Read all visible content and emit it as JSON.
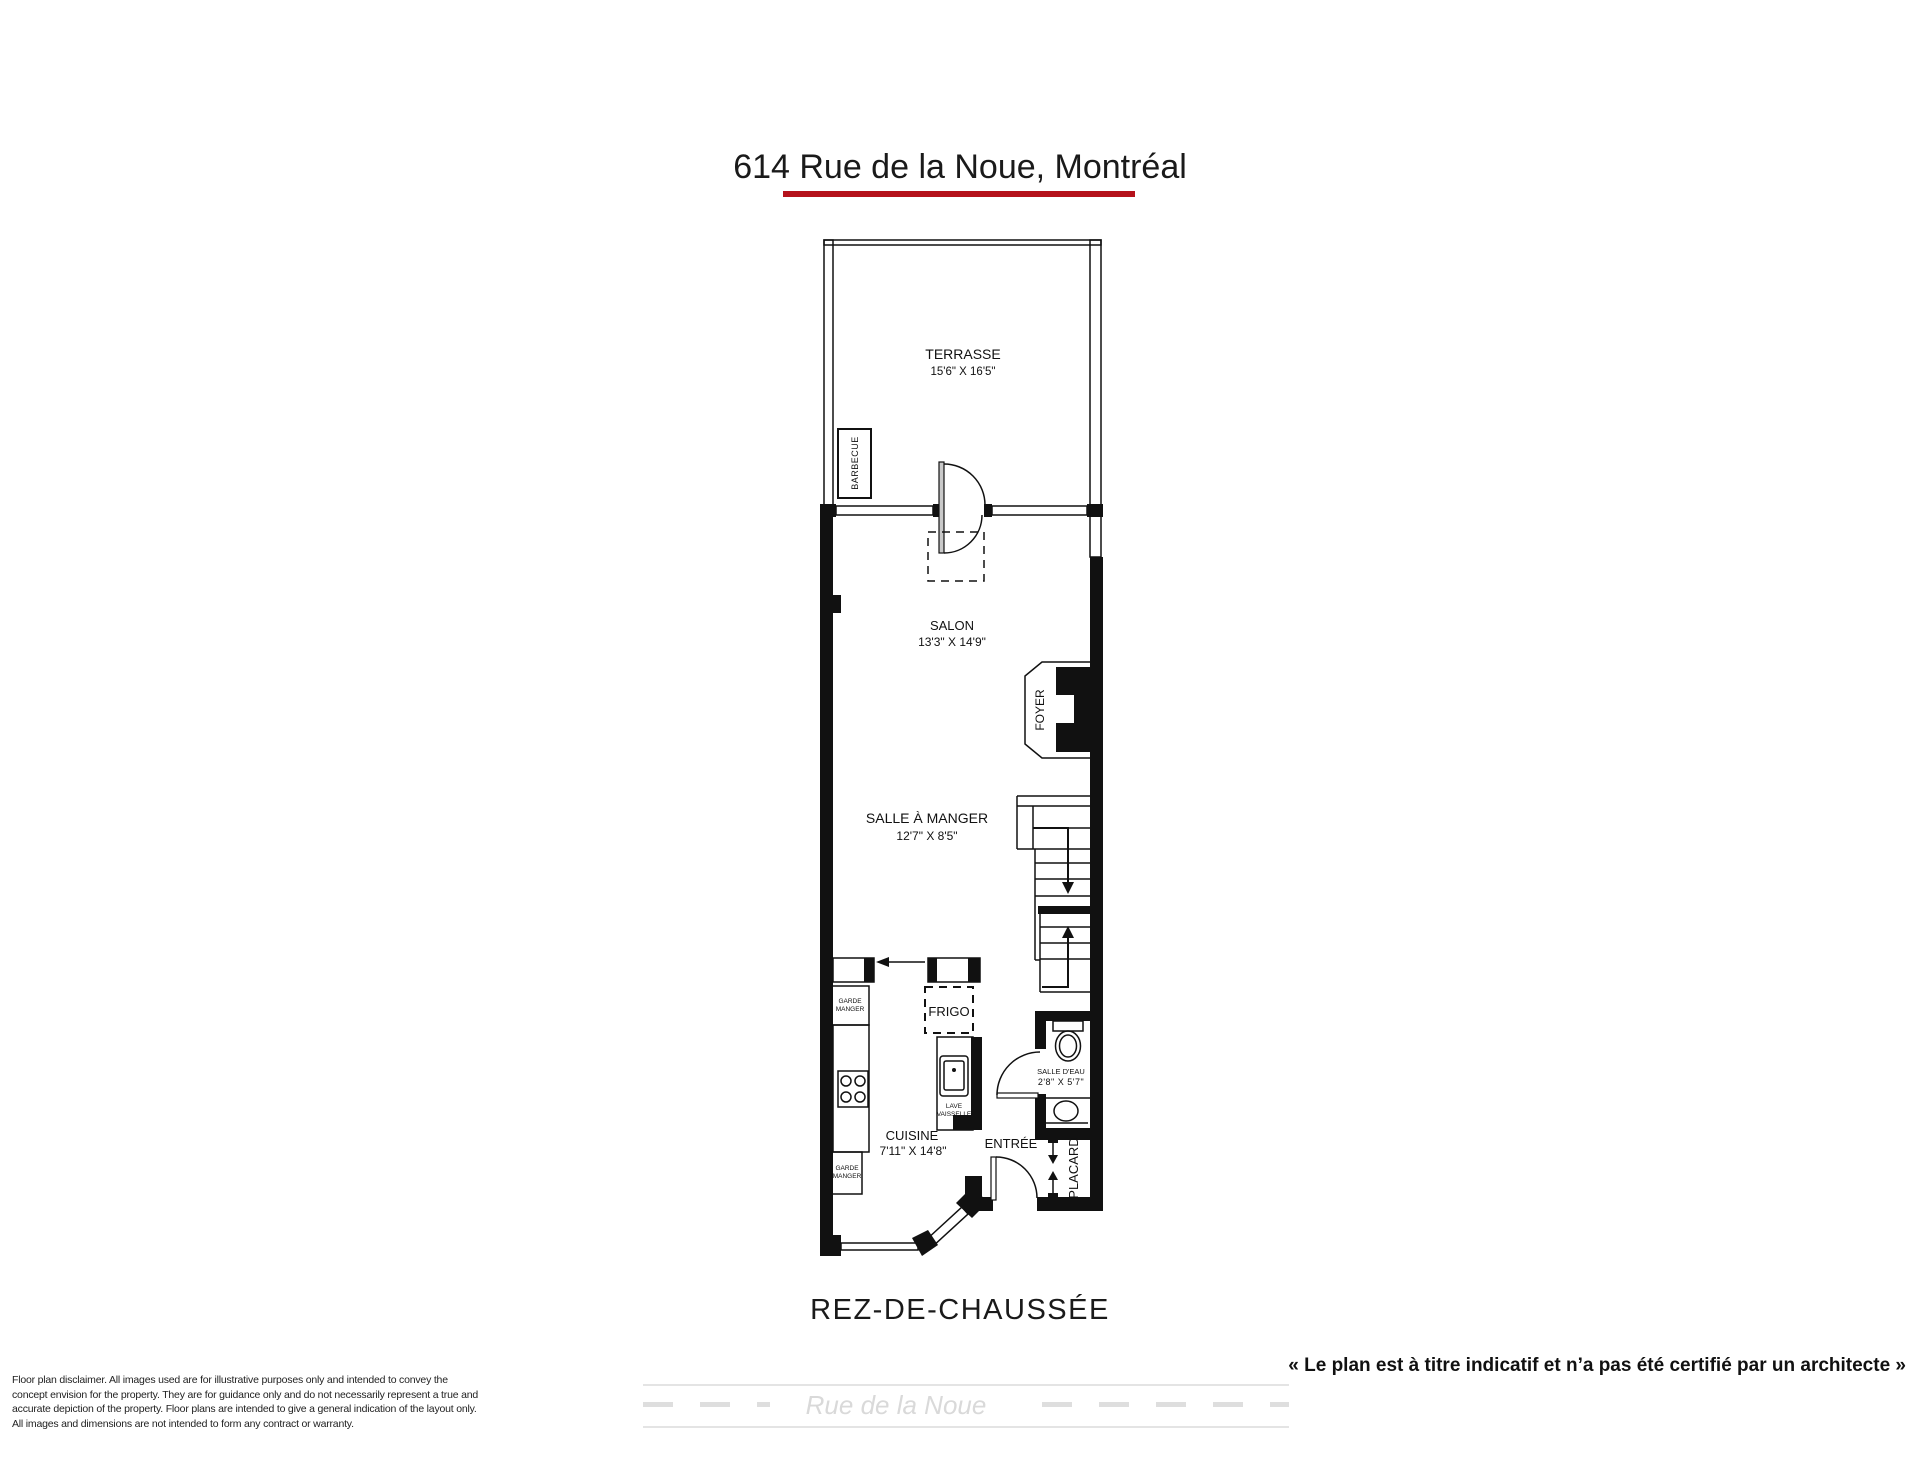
{
  "page": {
    "title": "614 Rue de la Noue, Montréal",
    "floor_label": "REZ-DE-CHAUSSÉE",
    "architect_note": "« Le plan est à titre indicatif et n’a pas été certifié par un architecte »",
    "street_name": "Rue de la Noue",
    "disclaimer_lines": [
      "Floor plan disclaimer. All images used are for illustrative purposes only and intended to convey the",
      "concept envision for the property. They are for guidance only and do not necessarily represent a true and",
      "accurate depiction of the property. Floor plans are intended to give a general indication of the layout only.",
      "All images and dimensions are not intended to form any contract or warranty."
    ]
  },
  "colors": {
    "accent_red": "#b5121b",
    "wall_black": "#111111",
    "street_gray": "#dedede"
  },
  "rooms": {
    "terrasse": {
      "name": "TERRASSE",
      "dims": "15'6\" X 16'5\""
    },
    "salon": {
      "name": "SALON",
      "dims": "13'3\" X 14'9\""
    },
    "salle_a_manger": {
      "name": "SALLE À MANGER",
      "dims": "12'7\" X 8'5\""
    },
    "cuisine": {
      "name": "CUISINE",
      "dims": "7'11\" X 14'8\""
    },
    "salle_deau": {
      "name": "SALLE D'EAU",
      "dims": "2'8\" X 5'7\""
    },
    "entree": {
      "name": "ENTRÉE"
    },
    "placard": {
      "name": "PLACARD"
    },
    "foyer": {
      "name": "FOYER"
    }
  },
  "fixtures": {
    "barbecue": "BARBECUE",
    "frigo": "FRIGO",
    "garde_manger_top": {
      "line1": "GARDE",
      "line2": "MANGER"
    },
    "garde_manger_bottom": {
      "line1": "GARDE",
      "line2": "MANGER"
    },
    "lave_vaisselle": {
      "line1": "LAVE",
      "line2": "VAISSELLE"
    }
  }
}
